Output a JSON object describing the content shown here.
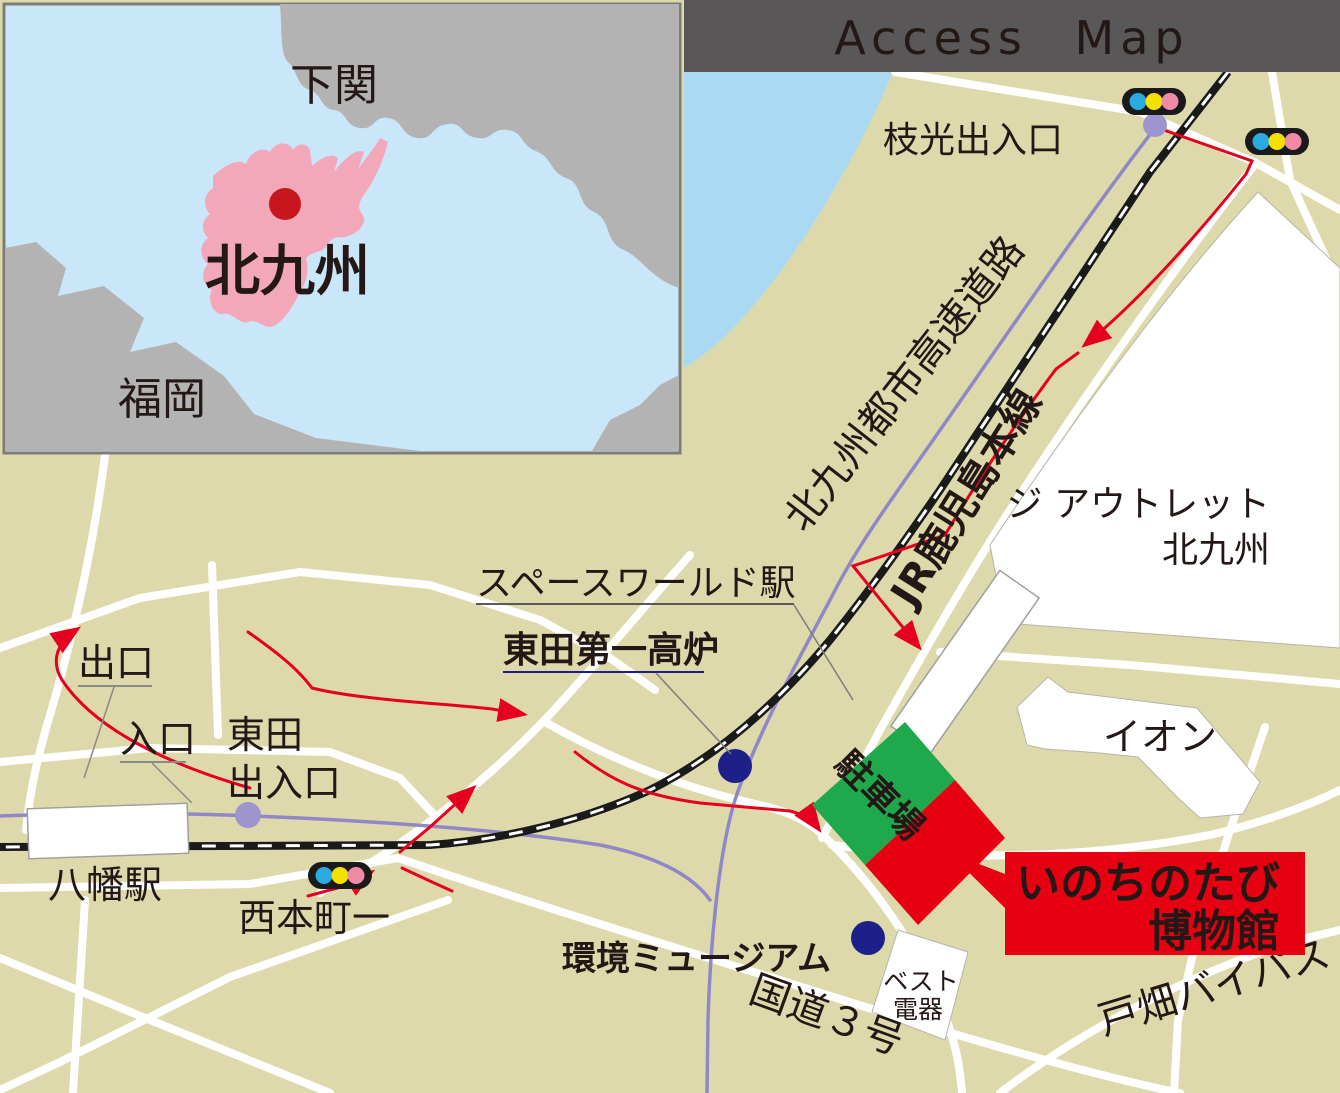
{
  "banner": {
    "title": "Access Map"
  },
  "inset": {
    "shimonoseki": "下関",
    "kitakyushu": "北九州",
    "fukuoka": "福岡"
  },
  "labels": {
    "edamitsu_ic": "枝光出入口",
    "urban_expressway": "北九州都市高速道路",
    "jr_kagoshima_line": "JR鹿児島本線",
    "outlet_line1": "ジ アウトレット",
    "outlet_line2": "北九州",
    "spaceworld_station": "スペースワールド駅",
    "blast_furnace": "東田第一高炉",
    "exit": "出口",
    "entrance": "入口",
    "higashida_ic_line1": "東田",
    "higashida_ic_line2": "出入口",
    "yahata_station": "八幡駅",
    "nishihonmachi": "西本町一",
    "env_museum": "環境ミュージアム",
    "parking": "駐車場",
    "museum_line1": "いのちのたび",
    "museum_line2": "博物館",
    "best_denki_line1": "ベスト",
    "best_denki_line2": "電器",
    "aeon": "イオン",
    "route3": "国道３号",
    "tobata_bypass": "戸畑バイパス"
  },
  "colors": {
    "land": "#ded9ab",
    "sea": "#a9daf2",
    "inset_sea": "#c9e7f9",
    "inset_land": "#b3b3b3",
    "inset_city_pink": "#f3a8ba",
    "inset_city_dot": "#c8161e",
    "banner_bg": "#595757",
    "banner_text": "#ffffff",
    "road": "#ffffff",
    "railway": "#1a1a1a",
    "expressway": "#8f87c7",
    "interchange_dot": "#9e95ce",
    "route_red": "#e60020",
    "museum_red": "#e60012",
    "parking_green": "#1fa84c",
    "navy": "#1d2088",
    "text_black": "#231815",
    "signal_blue": "#29abe2",
    "signal_yellow": "#f5e100",
    "signal_pink": "#f08ba6",
    "label_white": "#ffffff"
  }
}
